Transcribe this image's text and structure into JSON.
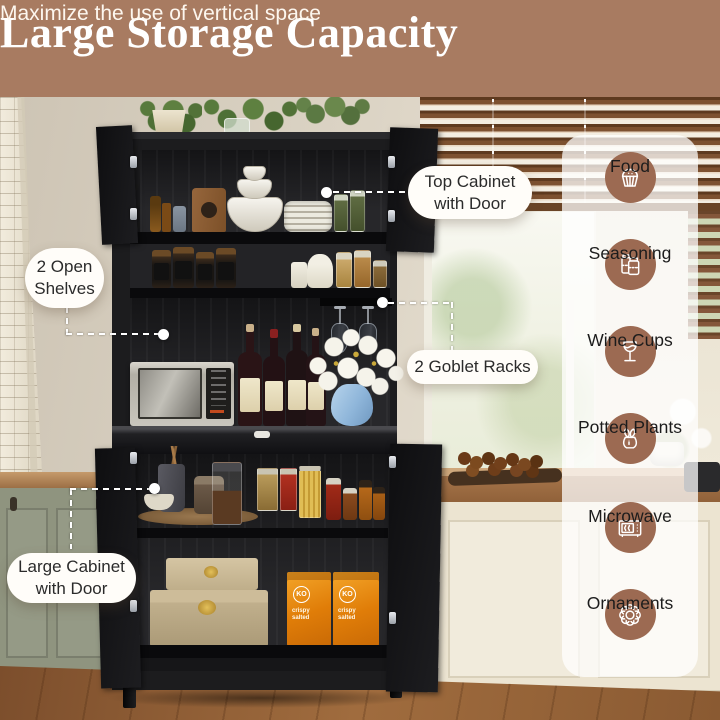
{
  "header": {
    "title": "Large Storage Capacity",
    "subtitle": "Maximize the use of vertical space"
  },
  "callouts": {
    "top_cabinet": "Top Cabinet\nwith Door",
    "open_shelves": "2 Open\nShelves",
    "goblet_racks": "2 Goblet Racks",
    "large_cabinet": "Large Cabinet\nwith Door"
  },
  "features": [
    {
      "label": "Food",
      "icon": "cupcake-icon"
    },
    {
      "label": "Seasoning",
      "icon": "seasoning-jars-icon"
    },
    {
      "label": "Wine Cups",
      "icon": "wine-glass-icon"
    },
    {
      "label": "Potted Plants",
      "icon": "potted-plant-icon"
    },
    {
      "label": "Microwave",
      "icon": "microwave-icon"
    },
    {
      "label": "Ornaments",
      "icon": "flower-ornament-icon"
    }
  ],
  "photo": {
    "snack_box_logo": "KO",
    "snack_box_caption": "crispy\nsalted"
  },
  "colors": {
    "banner_bg": "#a87b61",
    "icon_circle_bg": "#9c6a52",
    "callout_text": "#2b2b2b",
    "dashed_line": "#ffffff",
    "panel_bg": "rgba(255,255,255,0.74)"
  }
}
